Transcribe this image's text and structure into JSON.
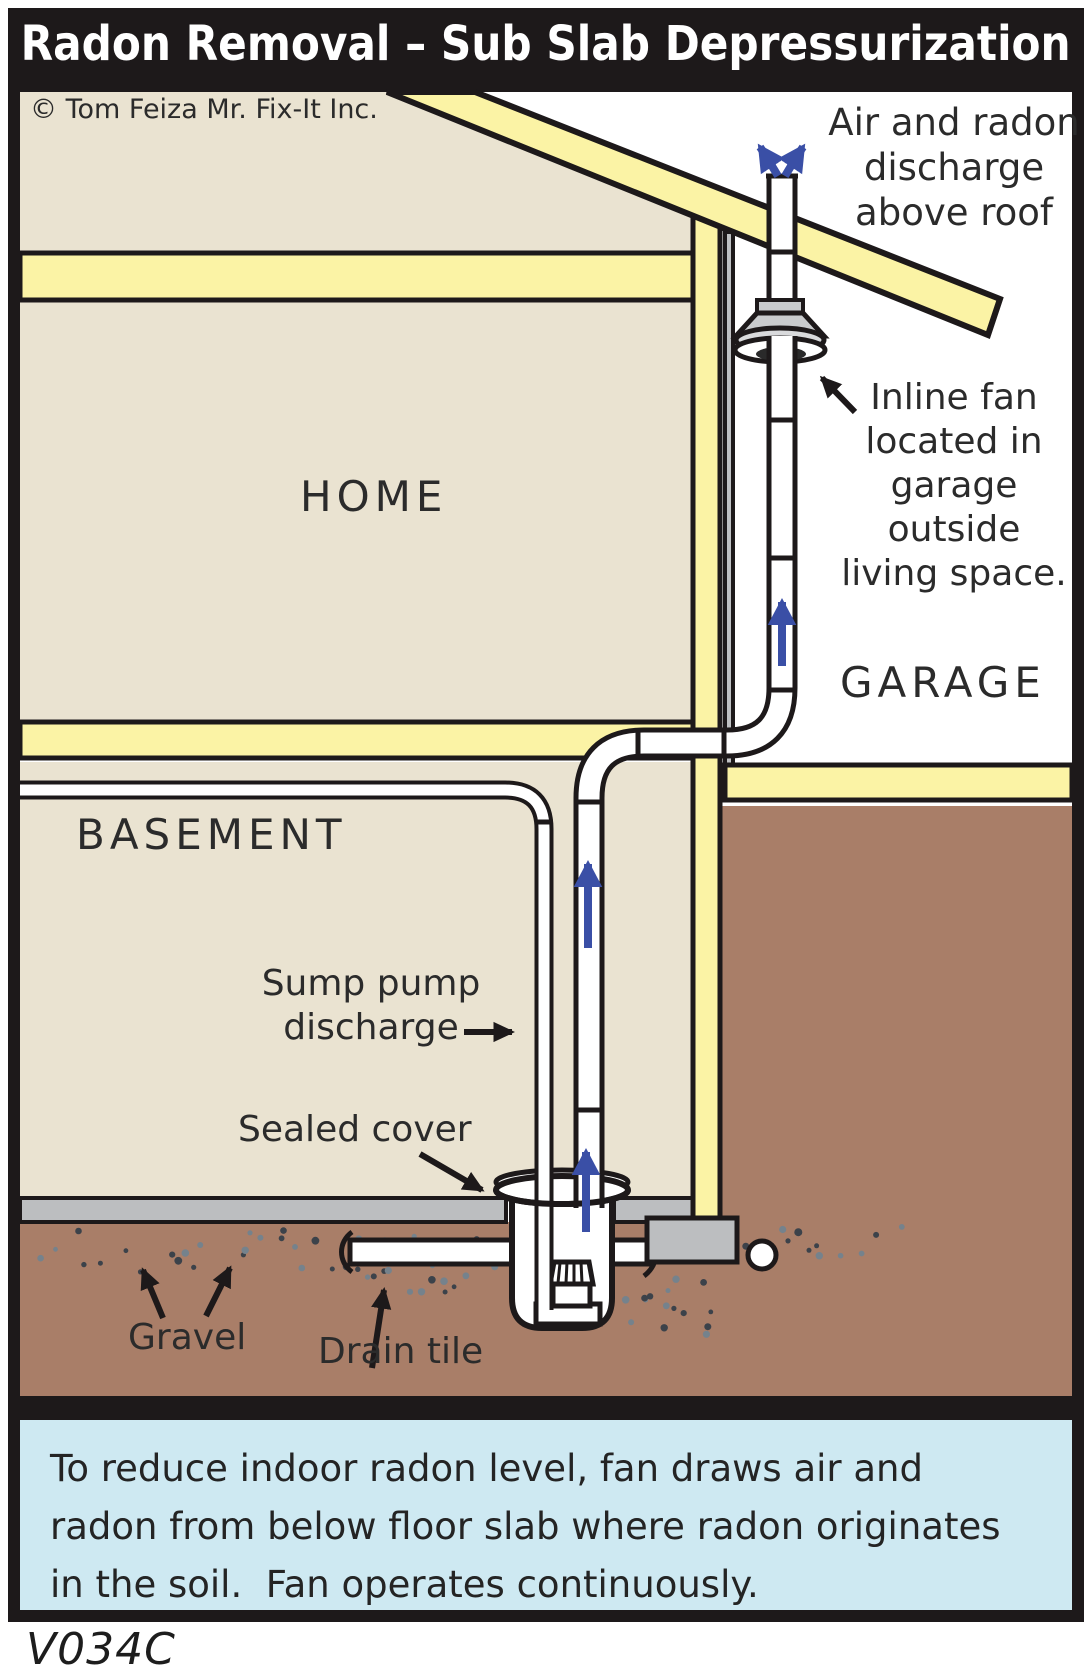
{
  "title": "Radon Removal – Sub Slab Depressurization",
  "copyright": "© Tom Feiza Mr. Fix-It Inc.",
  "rooms": {
    "home": "HOME",
    "garage": "GARAGE",
    "basement": "BASEMENT"
  },
  "annotations": {
    "air_discharge": [
      "Air and radon",
      "discharge",
      "above roof"
    ],
    "inline_fan": [
      "Inline fan",
      "located in",
      "garage outside",
      "living space."
    ],
    "sump_discharge": [
      "Sump pump",
      "discharge"
    ],
    "sealed_cover": "Sealed cover",
    "gravel": "Gravel",
    "drain_tile": "Drain tile"
  },
  "caption": {
    "line1": "To reduce indoor radon level, fan draws air and",
    "line2": "radon from below floor slab where radon originates",
    "line3": "in the soil.  Fan operates continuously."
  },
  "diagram_code": "V034C",
  "colors": {
    "line": "#1d191a",
    "wall_beige": "#eae3d1",
    "insulation_yellow": "#fbf3a5",
    "soil_brown": "#a97e68",
    "slab_gray": "#bcbec0",
    "fan_gray": "#c9cbcd",
    "arrow_blue": "#3a4fa6",
    "caption_bg": "#cee9f2",
    "title_bg": "#1d191a",
    "title_text": "#ffffff"
  }
}
